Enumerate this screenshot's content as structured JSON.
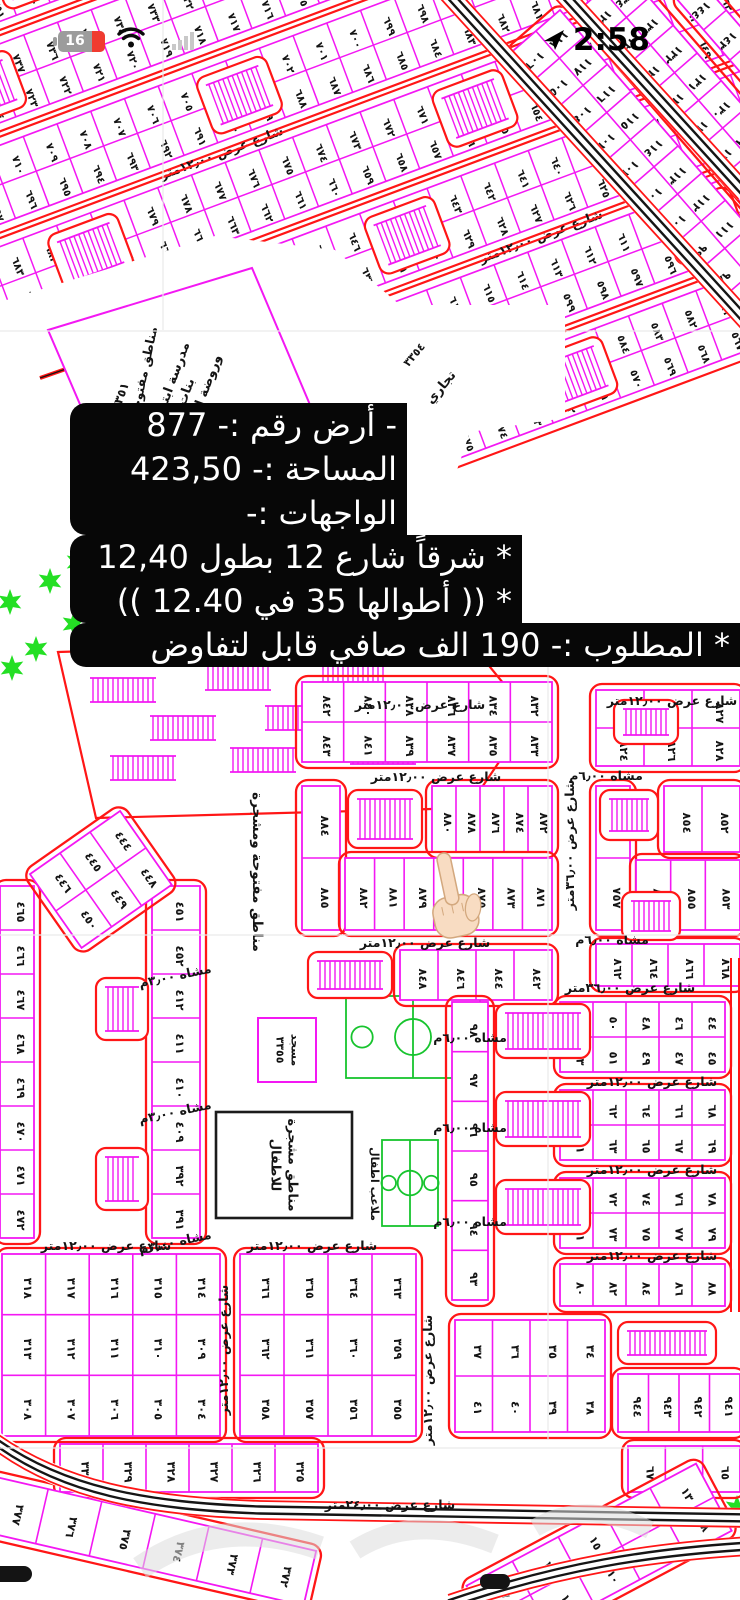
{
  "status_bar": {
    "battery_percent": "16",
    "time": "2:58",
    "icons": [
      "battery-icon",
      "wifi-icon",
      "signal-icon",
      "location-arrow-icon"
    ]
  },
  "listing_overlay": {
    "lines": [
      "- أرض رقم :- 877",
      "المساحة :- 423,50",
      "الواجهات :-",
      "* شرقاً شارع 12 بطول 12,40",
      "* (( أطوالها 35 في 12.40 ))",
      "* المطلوب :- 190 الف صافي قابل لتفاوض"
    ]
  },
  "map": {
    "colors": {
      "plot": "#f318f3",
      "road": "#ff1616",
      "text": "#141414",
      "hatch": "#f318f3",
      "green": "#24df24",
      "court": "#17c42e",
      "black_square": "#1c1c1c",
      "fold": "#e9e9e9",
      "watermark": "#dcdcdc"
    },
    "street_labels": {
      "w12": "شارع عرض ١٢٫٠٠متر",
      "w24": "شارع عرض ٢٤٫٠٠متر",
      "w36": "شارع عرض ٣٦٫٠٠متر",
      "ped6": "مشاه ٦٫٠٠م",
      "ped3": "مشاه ٣٫٠٠م"
    },
    "amenities": {
      "school": [
        "مدرسة ابتدائي",
        "بنات",
        "وروضة اطفال"
      ],
      "school_no": "٣٣٥١",
      "grand_mosque": "مسجد جامع",
      "grand_mosque_no": "٣٣٥٢",
      "commercial": "تجاري",
      "commercial_no": "٣٣٥٤",
      "mosque": "مسجد",
      "mosque_no": "٣٣٥٥",
      "open_area": "مناطق مفتوحة ومشجرة",
      "kids_trees": [
        "مناطق مشجرة",
        "للاطفال"
      ],
      "kids_courts": "ملاعب اطفال"
    },
    "pointed_plot": "٨٧٧",
    "hand": {
      "skin": "#f8dcc2",
      "edge": "#d3a87e"
    },
    "diag": {
      "angle": -20.5,
      "u0": -170,
      "len": 1080,
      "bands": [
        {
          "v": -54,
          "a": 769,
          "b": 755,
          "combs": [
            0.16,
            0.56
          ],
          "label": 0.36
        },
        {
          "v": 41,
          "a": 741,
          "b": 727,
          "combs": [
            0.08,
            0.47,
            0.8
          ],
          "label": 0.6
        },
        {
          "v": 136,
          "a": 713,
          "b": 699,
          "combs": [
            0.3,
            0.72
          ],
          "label": 0.3
        },
        {
          "v": 231,
          "a": 685,
          "b": 671,
          "combs": [
            0.12,
            0.5,
            0.86
          ]
        },
        {
          "v": 326,
          "a": 657,
          "b": 643,
          "combs": [
            0.4
          ],
          "label": 0.55
        },
        {
          "v": 421,
          "a": 629,
          "b": 615,
          "combs": [
            0.2,
            0.66
          ]
        },
        {
          "v": 516,
          "a": 601,
          "b": 587,
          "combs": [
            0.5
          ]
        }
      ]
    },
    "steep_blocks": [
      {
        "tr": "translate(560,10) rotate(49)",
        "x": 0,
        "y": 0,
        "w": 432,
        "h": 64,
        "rows": [
          [
            118,
            117,
            116,
            115,
            114,
            113,
            112,
            111,
            110,
            109,
            108,
            107
          ],
          [
            106,
            105,
            104,
            103,
            102,
            101,
            100,
            99,
            98,
            97,
            96,
            95
          ]
        ]
      },
      {
        "tr": "translate(625,-30) rotate(49)",
        "x": 0,
        "y": 0,
        "w": 330,
        "h": 60,
        "rows": [
          [
            134,
            133,
            132,
            131,
            130,
            129,
            128,
            127,
            126
          ],
          [
            126,
            125,
            124,
            123,
            122,
            121,
            120,
            119,
            118
          ]
        ]
      },
      {
        "tr": "translate(700,-20) rotate(49)",
        "x": 0,
        "y": 0,
        "w": 200,
        "h": 30,
        "rows": [
          [
            144,
            143,
            142,
            141,
            140
          ]
        ]
      }
    ],
    "blocks": [
      {
        "x": 302,
        "y": 682,
        "w": 250,
        "h": 80,
        "rows": [
          [
            842,
            840,
            838,
            836,
            834,
            832
          ],
          [
            843,
            841,
            839,
            837,
            835,
            833
          ]
        ]
      },
      {
        "x": 302,
        "y": 786,
        "w": 38,
        "h": 144,
        "rows": [
          [
            884
          ],
          [
            885
          ]
        ]
      },
      {
        "x": 432,
        "y": 786,
        "w": 120,
        "h": 66,
        "rows": [
          [
            880,
            878,
            876,
            874,
            872
          ]
        ]
      },
      {
        "x": 345,
        "y": 858,
        "w": 207,
        "h": 72,
        "rows": [
          [
            882,
            881,
            879,
            877,
            875,
            873,
            871
          ]
        ]
      },
      {
        "x": 400,
        "y": 950,
        "w": 152,
        "h": 50,
        "rows": [
          [
            848,
            846,
            844,
            842
          ]
        ]
      },
      {
        "x": 596,
        "y": 690,
        "w": 144,
        "h": 76,
        "rows": [
          [
            823,
            825,
            827
          ],
          [
            824,
            826,
            828
          ]
        ]
      },
      {
        "x": 596,
        "y": 786,
        "w": 34,
        "h": 144,
        "rows": [
          [
            756
          ],
          [
            757
          ]
        ]
      },
      {
        "x": 664,
        "y": 786,
        "w": 76,
        "h": 66,
        "rows": [
          [
            854,
            852
          ]
        ]
      },
      {
        "x": 636,
        "y": 860,
        "w": 104,
        "h": 70,
        "rows": [
          [
            856,
            855,
            853
          ]
        ]
      },
      {
        "x": 596,
        "y": 944,
        "w": 144,
        "h": 42,
        "rows": [
          [
            862,
            864,
            866,
            868
          ]
        ]
      },
      {
        "x": 452,
        "y": 1002,
        "w": 36,
        "h": 298,
        "rows": [
          [
            98
          ],
          [
            97
          ],
          [
            96
          ],
          [
            95
          ],
          [
            94
          ],
          [
            93
          ]
        ]
      },
      {
        "x": 560,
        "y": 1002,
        "w": 165,
        "h": 70,
        "rows": [
          [
            52,
            50,
            48,
            46,
            44
          ],
          [
            53,
            51,
            49,
            47,
            45
          ]
        ]
      },
      {
        "x": 560,
        "y": 1090,
        "w": 165,
        "h": 70,
        "rows": [
          [
            60,
            62,
            64,
            66,
            68
          ],
          [
            61,
            63,
            65,
            67,
            69
          ]
        ]
      },
      {
        "x": 560,
        "y": 1178,
        "w": 165,
        "h": 70,
        "rows": [
          [
            70,
            72,
            74,
            76,
            78
          ],
          [
            71,
            73,
            75,
            77,
            79
          ]
        ]
      },
      {
        "x": 560,
        "y": 1264,
        "w": 165,
        "h": 42,
        "rows": [
          [
            80,
            82,
            84,
            86,
            88
          ]
        ]
      },
      {
        "x": 152,
        "y": 886,
        "w": 48,
        "h": 352,
        "rows": [
          [
            451
          ],
          [
            452
          ],
          [
            412
          ],
          [
            411
          ],
          [
            410
          ],
          [
            409
          ],
          [
            392
          ],
          [
            391
          ]
        ]
      },
      {
        "x": 0,
        "y": 886,
        "w": 34,
        "h": 352,
        "rows": [
          [
            465
          ],
          [
            466
          ],
          [
            467
          ],
          [
            468
          ],
          [
            469
          ],
          [
            470
          ],
          [
            471
          ],
          [
            472
          ]
        ]
      },
      {
        "x": 2,
        "y": 1254,
        "w": 218,
        "h": 182,
        "rows": [
          [
            318,
            317,
            316,
            315,
            314
          ],
          [
            313,
            312,
            311,
            310,
            309
          ],
          [
            308,
            307,
            306,
            305,
            304
          ]
        ]
      },
      {
        "x": 240,
        "y": 1254,
        "w": 176,
        "h": 182,
        "rows": [
          [
            366,
            365,
            364,
            363
          ],
          [
            362,
            361,
            360,
            359
          ],
          [
            358,
            357,
            356,
            355
          ]
        ]
      },
      {
        "x": 455,
        "y": 1320,
        "w": 150,
        "h": 112,
        "rows": [
          [
            37,
            36,
            35,
            34
          ],
          [
            41,
            40,
            39,
            38
          ]
        ]
      },
      {
        "x": 618,
        "y": 1374,
        "w": 122,
        "h": 58,
        "rows": [
          [
            944,
            943,
            942,
            941
          ]
        ]
      },
      {
        "x": 60,
        "y": 1444,
        "w": 258,
        "h": 48,
        "rows": [
          [
            330,
            329,
            328,
            327,
            326,
            325
          ]
        ]
      },
      {
        "x": 628,
        "y": 1446,
        "w": 112,
        "h": 46,
        "rows": [
          [
            67,
            66,
            65
          ]
        ]
      },
      {
        "tr": "rotate(-35 100 880)",
        "x": 46,
        "y": 835,
        "w": 110,
        "h": 90,
        "rows": [
          [
            446,
            445,
            444
          ],
          [
            450,
            449,
            448
          ]
        ]
      },
      {
        "tr": "rotate(13 0 1480)",
        "x": -6,
        "y": 1478,
        "w": 330,
        "h": 56,
        "rows": [
          [
            377,
            376,
            375,
            374,
            373,
            372
          ]
        ]
      },
      {
        "tr": "rotate(-28 600 1560)",
        "x": 470,
        "y": 1520,
        "w": 260,
        "h": 76,
        "rows": [
          [
            17,
            16,
            15,
            14,
            13
          ],
          [
            12,
            11,
            10,
            9,
            8
          ]
        ]
      }
    ],
    "comb_boxes": [
      [
        348,
        790,
        74,
        58
      ],
      [
        614,
        700,
        64,
        44
      ],
      [
        600,
        790,
        58,
        50
      ],
      [
        622,
        892,
        58,
        48
      ],
      [
        308,
        952,
        84,
        46
      ],
      [
        496,
        1004,
        94,
        54
      ],
      [
        496,
        1092,
        94,
        54
      ],
      [
        496,
        1180,
        94,
        54
      ],
      [
        96,
        978,
        52,
        62
      ],
      [
        96,
        1148,
        52,
        62
      ],
      [
        618,
        1322,
        98,
        42
      ]
    ],
    "combs_plain": [
      [
        344,
        1286,
        24,
        58,
        1
      ],
      [
        90,
        678,
        66,
        24,
        0
      ],
      [
        205,
        666,
        66,
        24,
        0
      ],
      [
        320,
        658,
        66,
        24,
        0
      ],
      [
        150,
        716,
        66,
        24,
        0
      ],
      [
        265,
        706,
        66,
        24,
        0
      ],
      [
        380,
        698,
        66,
        24,
        0
      ],
      [
        110,
        756,
        66,
        24,
        0
      ],
      [
        230,
        748,
        66,
        24,
        0
      ],
      [
        350,
        740,
        66,
        24,
        0
      ]
    ],
    "labels": [
      {
        "k": "w12",
        "x": 420,
        "y": 709
      },
      {
        "k": "w12",
        "x": 672,
        "y": 705
      },
      {
        "k": "ped6",
        "x": 606,
        "y": 780
      },
      {
        "k": "w12",
        "x": 436,
        "y": 781
      },
      {
        "k": "w12",
        "x": 425,
        "y": 947
      },
      {
        "k": "ped6",
        "x": 612,
        "y": 944
      },
      {
        "k": "w36",
        "x": 630,
        "y": 992
      },
      {
        "k": "w36",
        "x": 574,
        "y": 845,
        "rot": -90
      },
      {
        "k": "ped6",
        "x": 470,
        "y": 1042
      },
      {
        "k": "w12",
        "x": 652,
        "y": 1086
      },
      {
        "k": "ped6",
        "x": 470,
        "y": 1132
      },
      {
        "k": "w12",
        "x": 652,
        "y": 1174
      },
      {
        "k": "ped6",
        "x": 470,
        "y": 1226
      },
      {
        "k": "w12",
        "x": 652,
        "y": 1260
      },
      {
        "k": "ped3",
        "x": 176,
        "y": 980,
        "rot": -12
      },
      {
        "k": "ped3",
        "x": 176,
        "y": 1116,
        "rot": -12
      },
      {
        "k": "ped3",
        "x": 176,
        "y": 1246,
        "rot": -12
      },
      {
        "k": "w12",
        "x": 106,
        "y": 1250
      },
      {
        "k": "w12",
        "x": 312,
        "y": 1250
      },
      {
        "k": "w12",
        "x": 228,
        "y": 1350,
        "rot": -90
      },
      {
        "k": "w12",
        "x": 432,
        "y": 1380,
        "rot": -90
      },
      {
        "k": "w24",
        "x": 390,
        "y": 1509
      }
    ],
    "whiteout": "0,302 215,236 335,250 400,305 565,305 565,418 470,432 426,560 502,652 310,668 0,672",
    "school_poly": "48,330 252,268 330,452 128,516",
    "parking": "58,652 468,640 530,716 468,808 96,818",
    "school_street": [
      40,
      378,
      235,
      310
    ],
    "roads_straight": [
      [
        445,
        -10,
        755,
        330
      ],
      [
        560,
        -10,
        745,
        193
      ]
    ],
    "curve_bottom": [
      [
        -12,
        1436
      ],
      [
        60,
        1492
      ],
      [
        150,
        1506
      ],
      [
        260,
        1510
      ],
      [
        750,
        1518
      ]
    ],
    "curve_br": [
      [
        448,
        1604
      ],
      [
        560,
        1566
      ],
      [
        650,
        1552
      ],
      [
        750,
        1546
      ]
    ],
    "red_lines": [
      [
        731,
        958,
        731,
        1312
      ],
      [
        739,
        958,
        739,
        1312
      ]
    ],
    "stars": [
      [
        78,
        562
      ],
      [
        50,
        581
      ],
      [
        10,
        602
      ],
      [
        104,
        613
      ],
      [
        74,
        624
      ],
      [
        36,
        649
      ],
      [
        12,
        668
      ],
      [
        95,
        545
      ],
      [
        737,
        1508
      ]
    ],
    "courts": [
      [
        346,
        996,
        134,
        82
      ],
      [
        382,
        1140,
        56,
        86
      ]
    ],
    "fold_lines": [
      [
        0,
        331,
        740,
        331
      ],
      [
        0,
        935,
        740,
        935
      ],
      [
        0,
        1448,
        740,
        1448
      ],
      [
        548,
        660,
        548,
        1440
      ],
      [
        163,
        0,
        163,
        330
      ]
    ]
  }
}
